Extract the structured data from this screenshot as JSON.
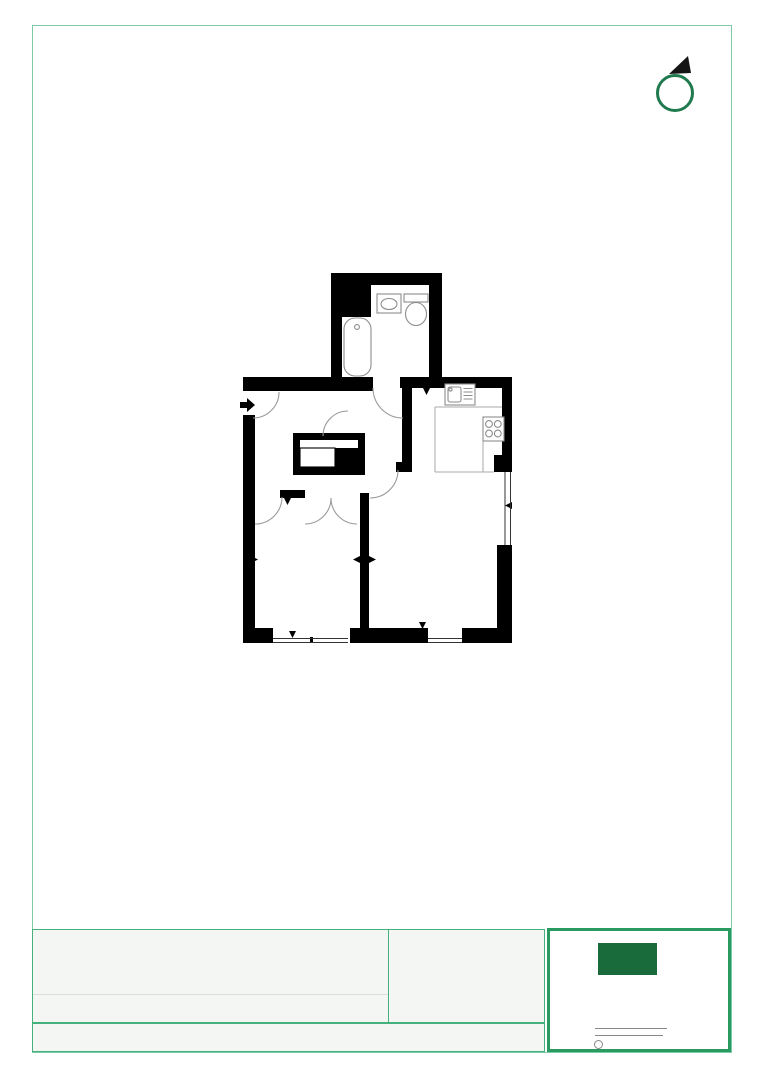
{
  "document": {
    "kind": "architectural-floor-plan-sheet"
  },
  "colors": {
    "page_background": "#ffffff",
    "frame_border": "#7ccaa7",
    "table_border": "#45b27e",
    "table_fill": "#f4f6f4",
    "table_divider": "#dddddd",
    "logo_box_border": "#2a9b60",
    "logo_fill": "#196b3c",
    "compass_ring": "#1f7a4e",
    "compass_pointer": "#151515",
    "walls": "#000000",
    "fixture_stroke": "#8c8c8c",
    "fixture_fill": "#ffffff",
    "door_swing_stroke": "#9a9a9a",
    "counter_stroke": "#aaaaaa",
    "window_stroke": "#333333",
    "signature_line": "#888888"
  },
  "north_arrow": {
    "icon": "compass-north-pointer",
    "direction": "north-east"
  },
  "floor_plan": {
    "rooms": [
      "bathroom",
      "hallway",
      "kitchen",
      "living-room",
      "bedroom",
      "built-in-closet"
    ],
    "fixtures": [
      "bathtub",
      "wash-basin",
      "toilet",
      "kitchen-sink",
      "cooktop-4-burner",
      "wardrobe-unit"
    ],
    "annotations": [
      "entrance-arrow",
      "door-swing-arcs",
      "window-openings",
      "section-markers"
    ]
  },
  "title_block": {
    "left_table": {
      "rows": 2,
      "columns": 2,
      "content": ""
    },
    "bottom_strip_content": "",
    "logo_panel": {
      "has_logo_mark": true,
      "signature_lines": 2,
      "has_stamp_circle": true
    }
  }
}
